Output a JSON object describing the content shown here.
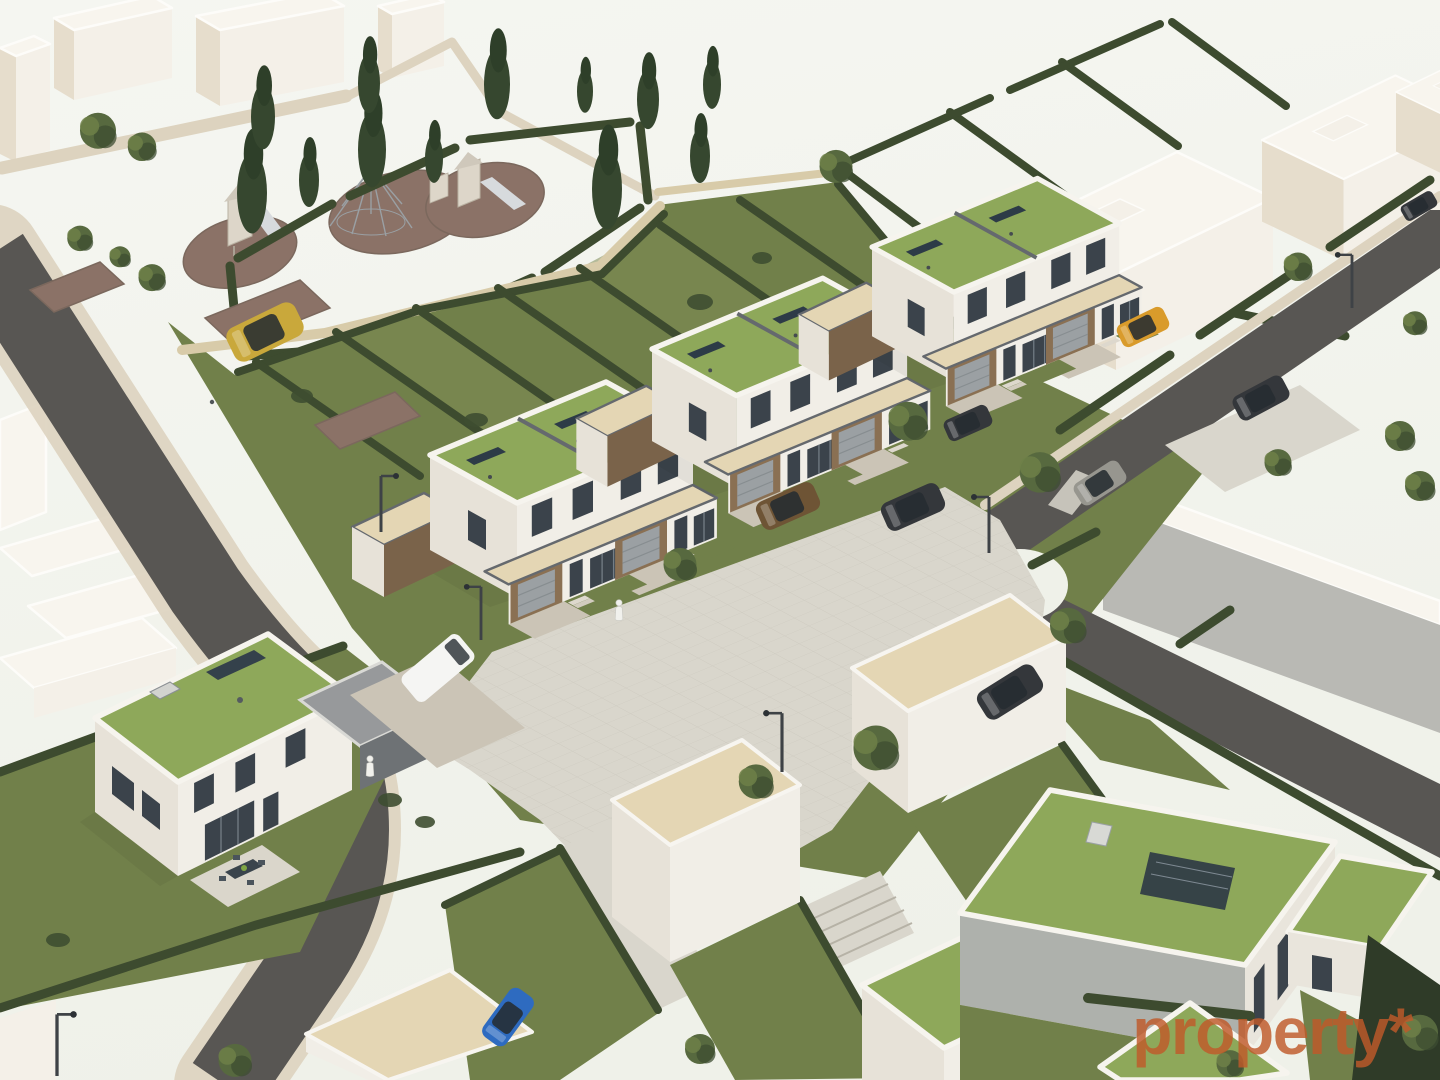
{
  "watermark": {
    "text": "property*",
    "color": "#c05a2a",
    "opacity": 0.82
  },
  "colors": {
    "background": "#eff1e9",
    "background_top": "#f5f6f1",
    "massing_wall": "#f4f0e8",
    "massing_shadow": "#e6ddcc",
    "massing_roof": "#f8f5ee",
    "house_wall": "#f1eee7",
    "house_wall_shade": "#e7e2d8",
    "green_roof": "#8ea85a",
    "green_roof_light": "#9db26a",
    "gravel_roof": "#e4d6b4",
    "parapet": "#65696e",
    "garage_brown": "#8a7053",
    "garage_brown_shade": "#7a634a",
    "garage_door": "#9ba0a3",
    "window": "#3b434b",
    "glass_frame": "#747e86",
    "lawn": "#71804a",
    "lawn_light": "#7d8b53",
    "hedge": "#3d4b2f",
    "mulch": "#8b7267",
    "asphalt": "#585653",
    "paving": "#d9d6cc",
    "paving_line": "#c9c6bb",
    "sidewalk": "#ddd3bf",
    "driveway": "#cbc4b6",
    "tree": "#57693f",
    "tree_dark": "#3e4e31",
    "poplar": "#36472f",
    "car_gold": "#c9a83b",
    "car_yellow": "#d99b2b",
    "car_bronze": "#6e5435",
    "car_dark": "#34373b",
    "car_blue": "#2e6bc0",
    "car_white": "#f5f5f3",
    "car_silver": "#97968f",
    "equipment_wood": "#ddd6c9",
    "slide_gray": "#d7dadd",
    "solar_panel": "#2d3b47",
    "watermark": "#c05a2a"
  },
  "scene": {
    "elements": [
      "context massing buildings",
      "public playground with two play towers and slides",
      "climbing-net structure",
      "poplar and deciduous trees",
      "hedged garden plots",
      "three semi-detached house pairs with sedum green roofs and rooftop solar panels",
      "detached house with green roof and terrace with dining table",
      "detached green-roof houses",
      "garage boxes",
      "solar carport",
      "shared paved plaza",
      "asphalt streets",
      "parked cars",
      "white van",
      "street lamps",
      "pedestrians"
    ],
    "counts": {
      "semi_detached_pairs": 3,
      "detached_green_roof_houses": 3,
      "garage_boxes": 3,
      "cars": 10,
      "vans": 1,
      "street_lamps": 6,
      "pedestrians": 2,
      "playground_towers": 2
    }
  }
}
